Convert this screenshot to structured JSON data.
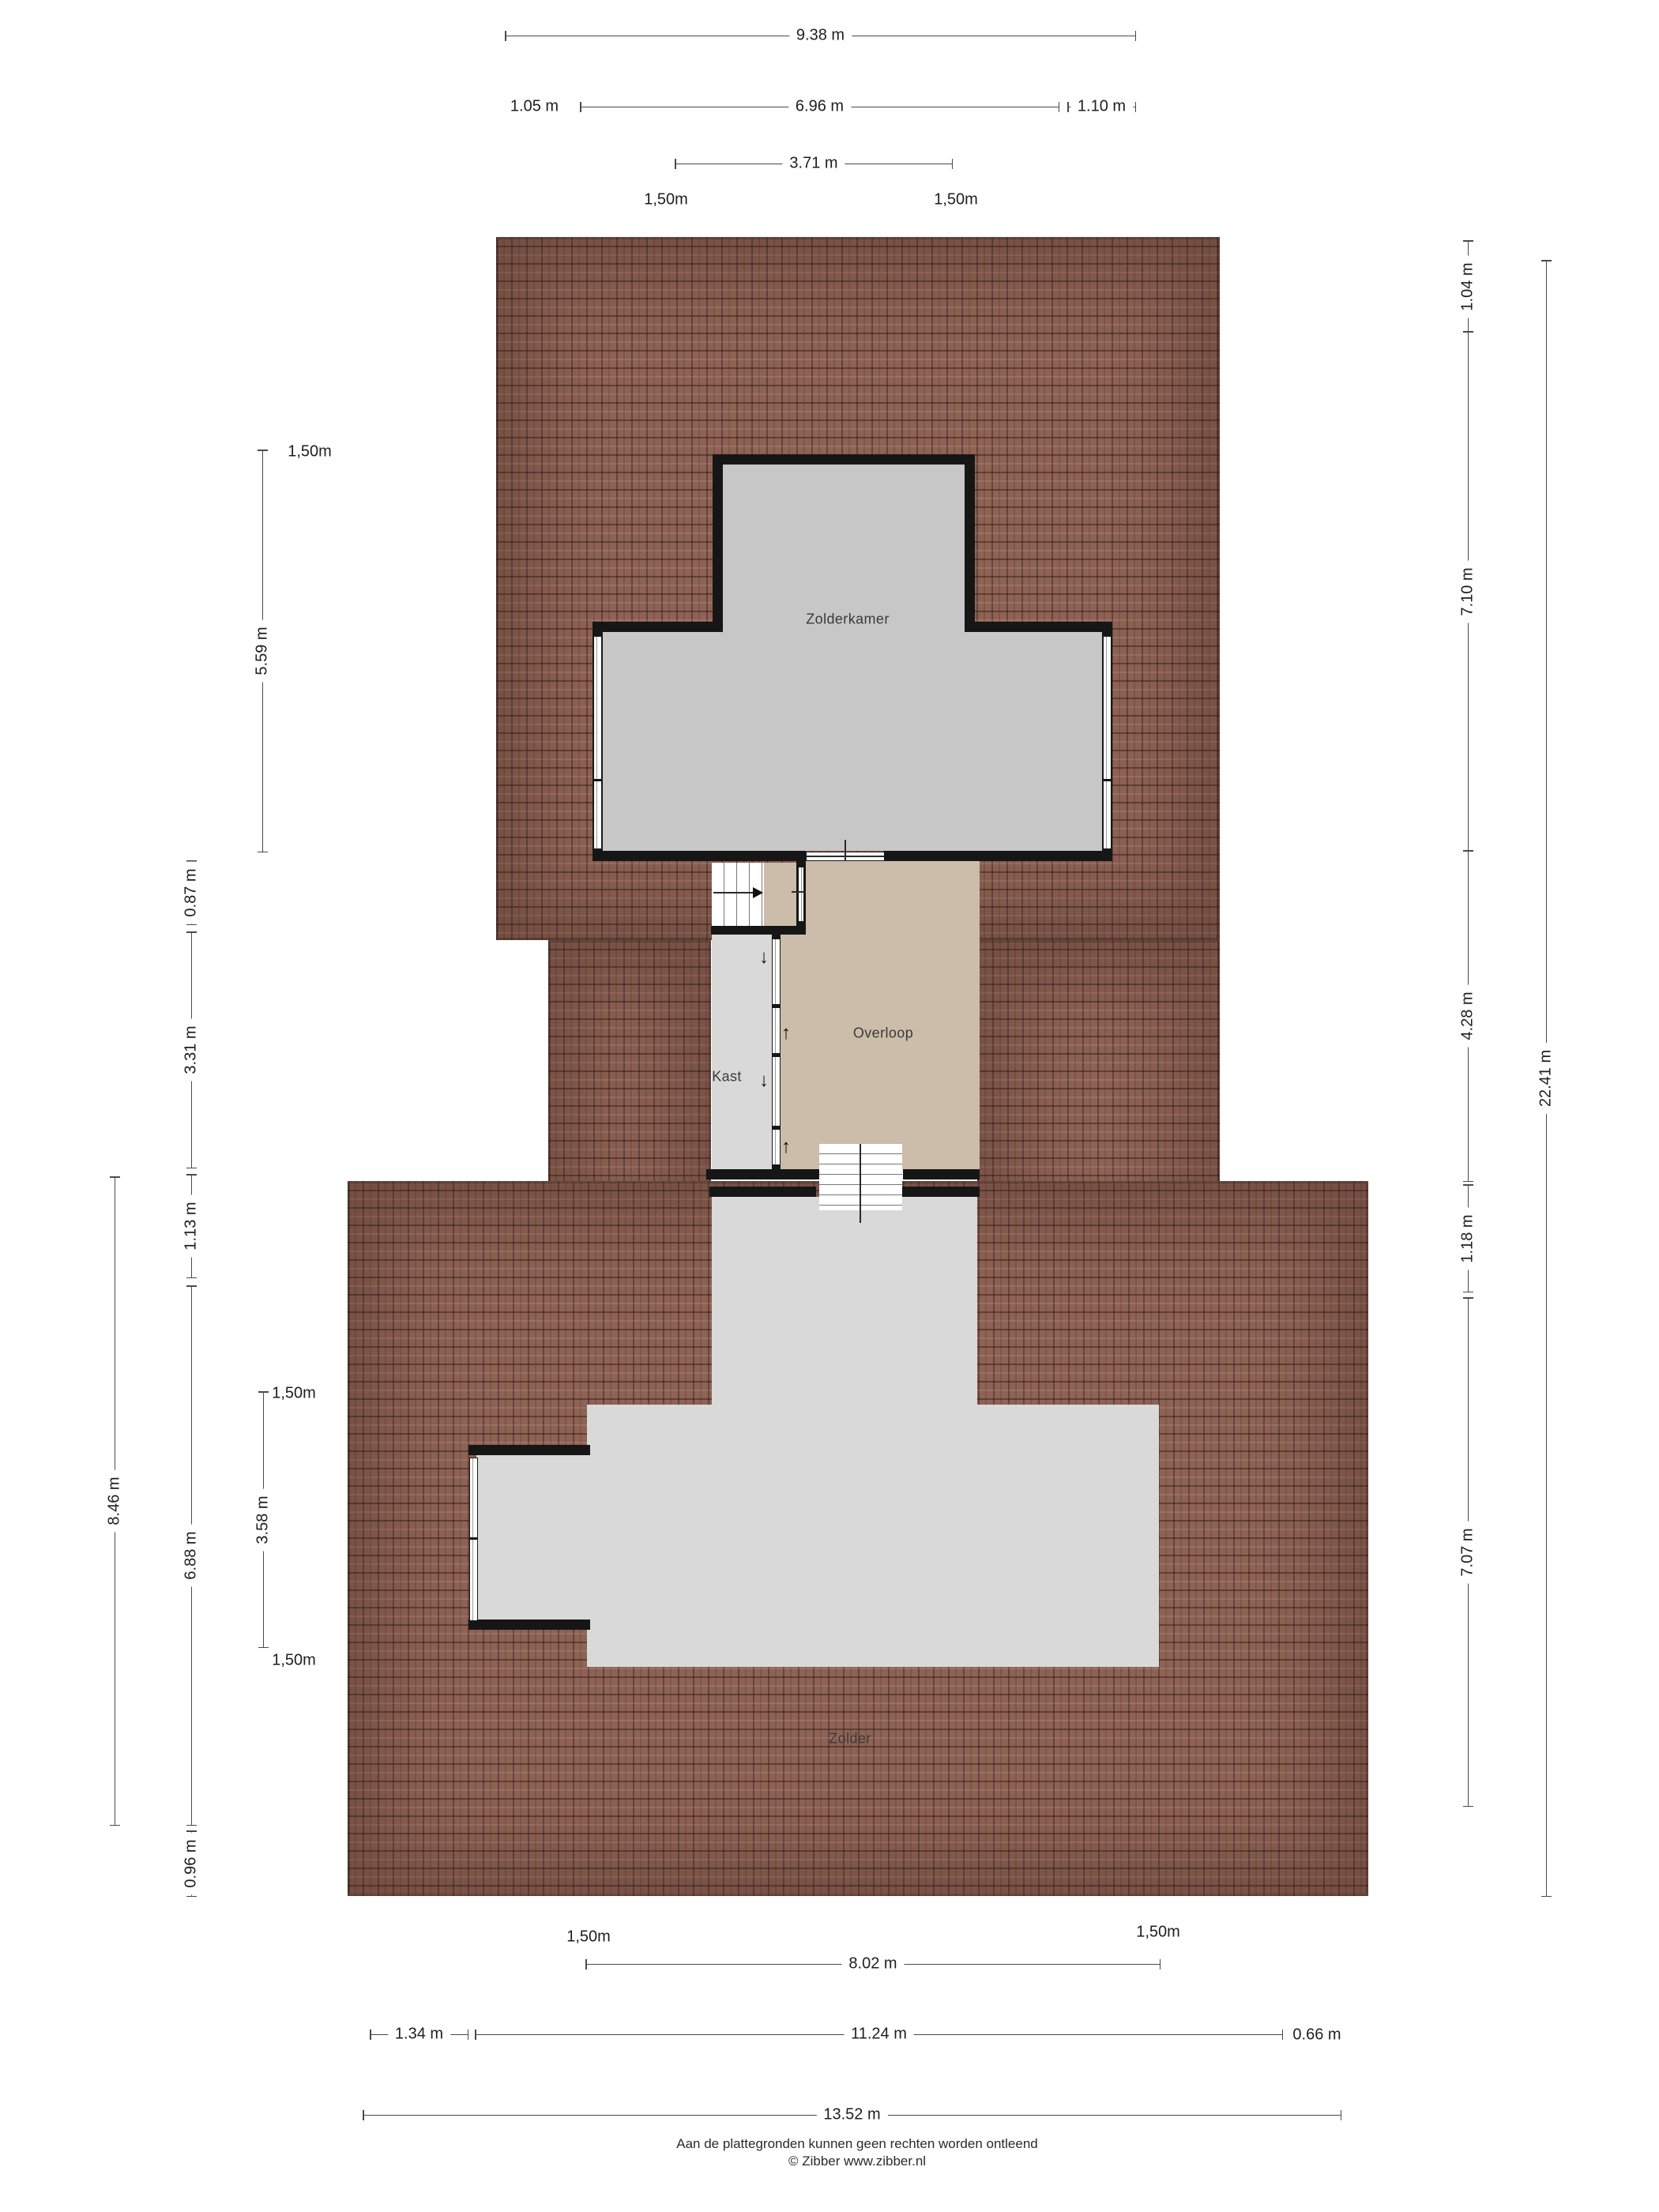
{
  "rooms": {
    "zolderkamer": "Zolderkamer",
    "overloop": "Overloop",
    "kast": "Kast",
    "zolder": "Zolder"
  },
  "dimensions": {
    "top": [
      "9.38 m",
      "1.05 m",
      "6.96 m",
      "1.10 m",
      "3.71 m"
    ],
    "top_contours": [
      "1,50m",
      "1,50m"
    ],
    "right": [
      "1.04 m",
      "7.10 m",
      "4.28 m",
      "1.18 m",
      "7.07 m",
      "22.41 m"
    ],
    "left": [
      "1,50m",
      "5.59 m",
      "0.87 m",
      "3.31 m",
      "1.13 m",
      "6.88 m",
      "0.96 m",
      "8.46 m",
      "1,50m",
      "3.58 m",
      "1,50m"
    ],
    "bottom": [
      "1,50m",
      "1,50m",
      "8.02 m",
      "1.34 m",
      "11.24 m",
      "0.66 m",
      "13.52 m"
    ]
  },
  "symbols": {
    "arrow_down": "↓",
    "arrow_up": "↑"
  },
  "footer": {
    "line1": "Aan de plattegronden kunnen geen rechten worden ontleend",
    "line2": "© Zibber www.zibber.nl"
  },
  "colors": {
    "roof": "#8e6254",
    "roof_line": "#2b1b16",
    "room_floor": "#c7c7c7",
    "light_floor": "#d9d9d9",
    "landing_floor": "#cbbdaa",
    "wall": "#161616",
    "dim_line": "#4a4a4a"
  }
}
